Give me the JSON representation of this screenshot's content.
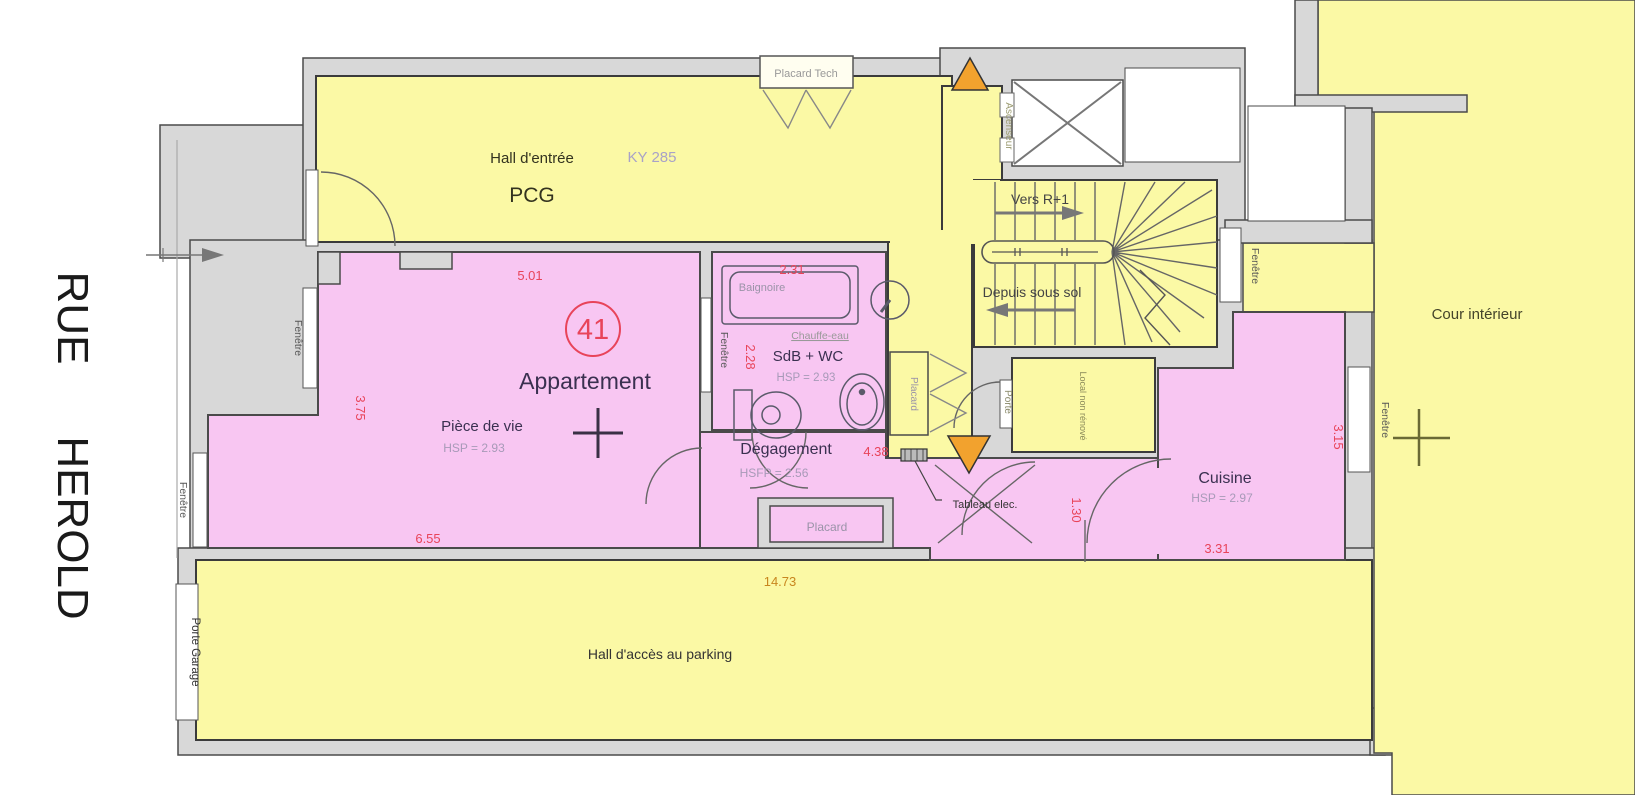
{
  "street": {
    "rue": "RUE",
    "herold": "HEROLD"
  },
  "common_areas": {
    "hall_entree": {
      "name": "Hall d'entrée",
      "code": "PCG",
      "ref": "KY 285"
    },
    "placard_tech": "Placard Tech",
    "ascenseur": "Ascenseur",
    "stairs": {
      "up": "Vers R+1",
      "down": "Depuis sous sol"
    },
    "porte": "Porte",
    "local": "Local non rénové",
    "cour": "Cour intérieur",
    "hall_parking": "Hall d'accès au parking",
    "porte_garage": "Porte Garage"
  },
  "apartment": {
    "number": "41",
    "label": "Appartement",
    "piece_de_vie": {
      "name": "Pièce de vie",
      "hsp": "HSP = 2.93"
    },
    "sdb": {
      "name": "SdB + WC",
      "hsp": "HSP = 2.93",
      "baignoire": "Baignoire",
      "chauffe_eau": "Chauffe-eau"
    },
    "degagement": {
      "name": "Dégagement",
      "hsfp": "HSFP = 2.56"
    },
    "placard": "Placard",
    "placard_bas": "Placard",
    "tableau": "Tableau elec.",
    "cuisine": {
      "name": "Cuisine",
      "hsp": "HSP = 2.97"
    }
  },
  "labels": {
    "fenetre": "Fenêtre"
  },
  "dimensions": {
    "piece_top": "5.01",
    "piece_left": "3.75",
    "piece_bottom": "6.55",
    "sdb_top": "2.31",
    "sdb_left": "2.28",
    "degagement_right": "4.38",
    "couloir": "1.30",
    "cuisine_right": "3.15",
    "cuisine_bottom": "3.31",
    "total_bottom": "14.73"
  },
  "colors": {
    "common_yellow": "#fbf9a5",
    "private_pink": "#f8c6f2",
    "wall_gray": "#d8d8d8",
    "dimension_red": "#e8445a",
    "dimension_orange": "#c8861e",
    "triangle_orange": "#f2a22e",
    "room_name_dark": "#3a3050",
    "hsp_gray": "#a79ab8"
  }
}
